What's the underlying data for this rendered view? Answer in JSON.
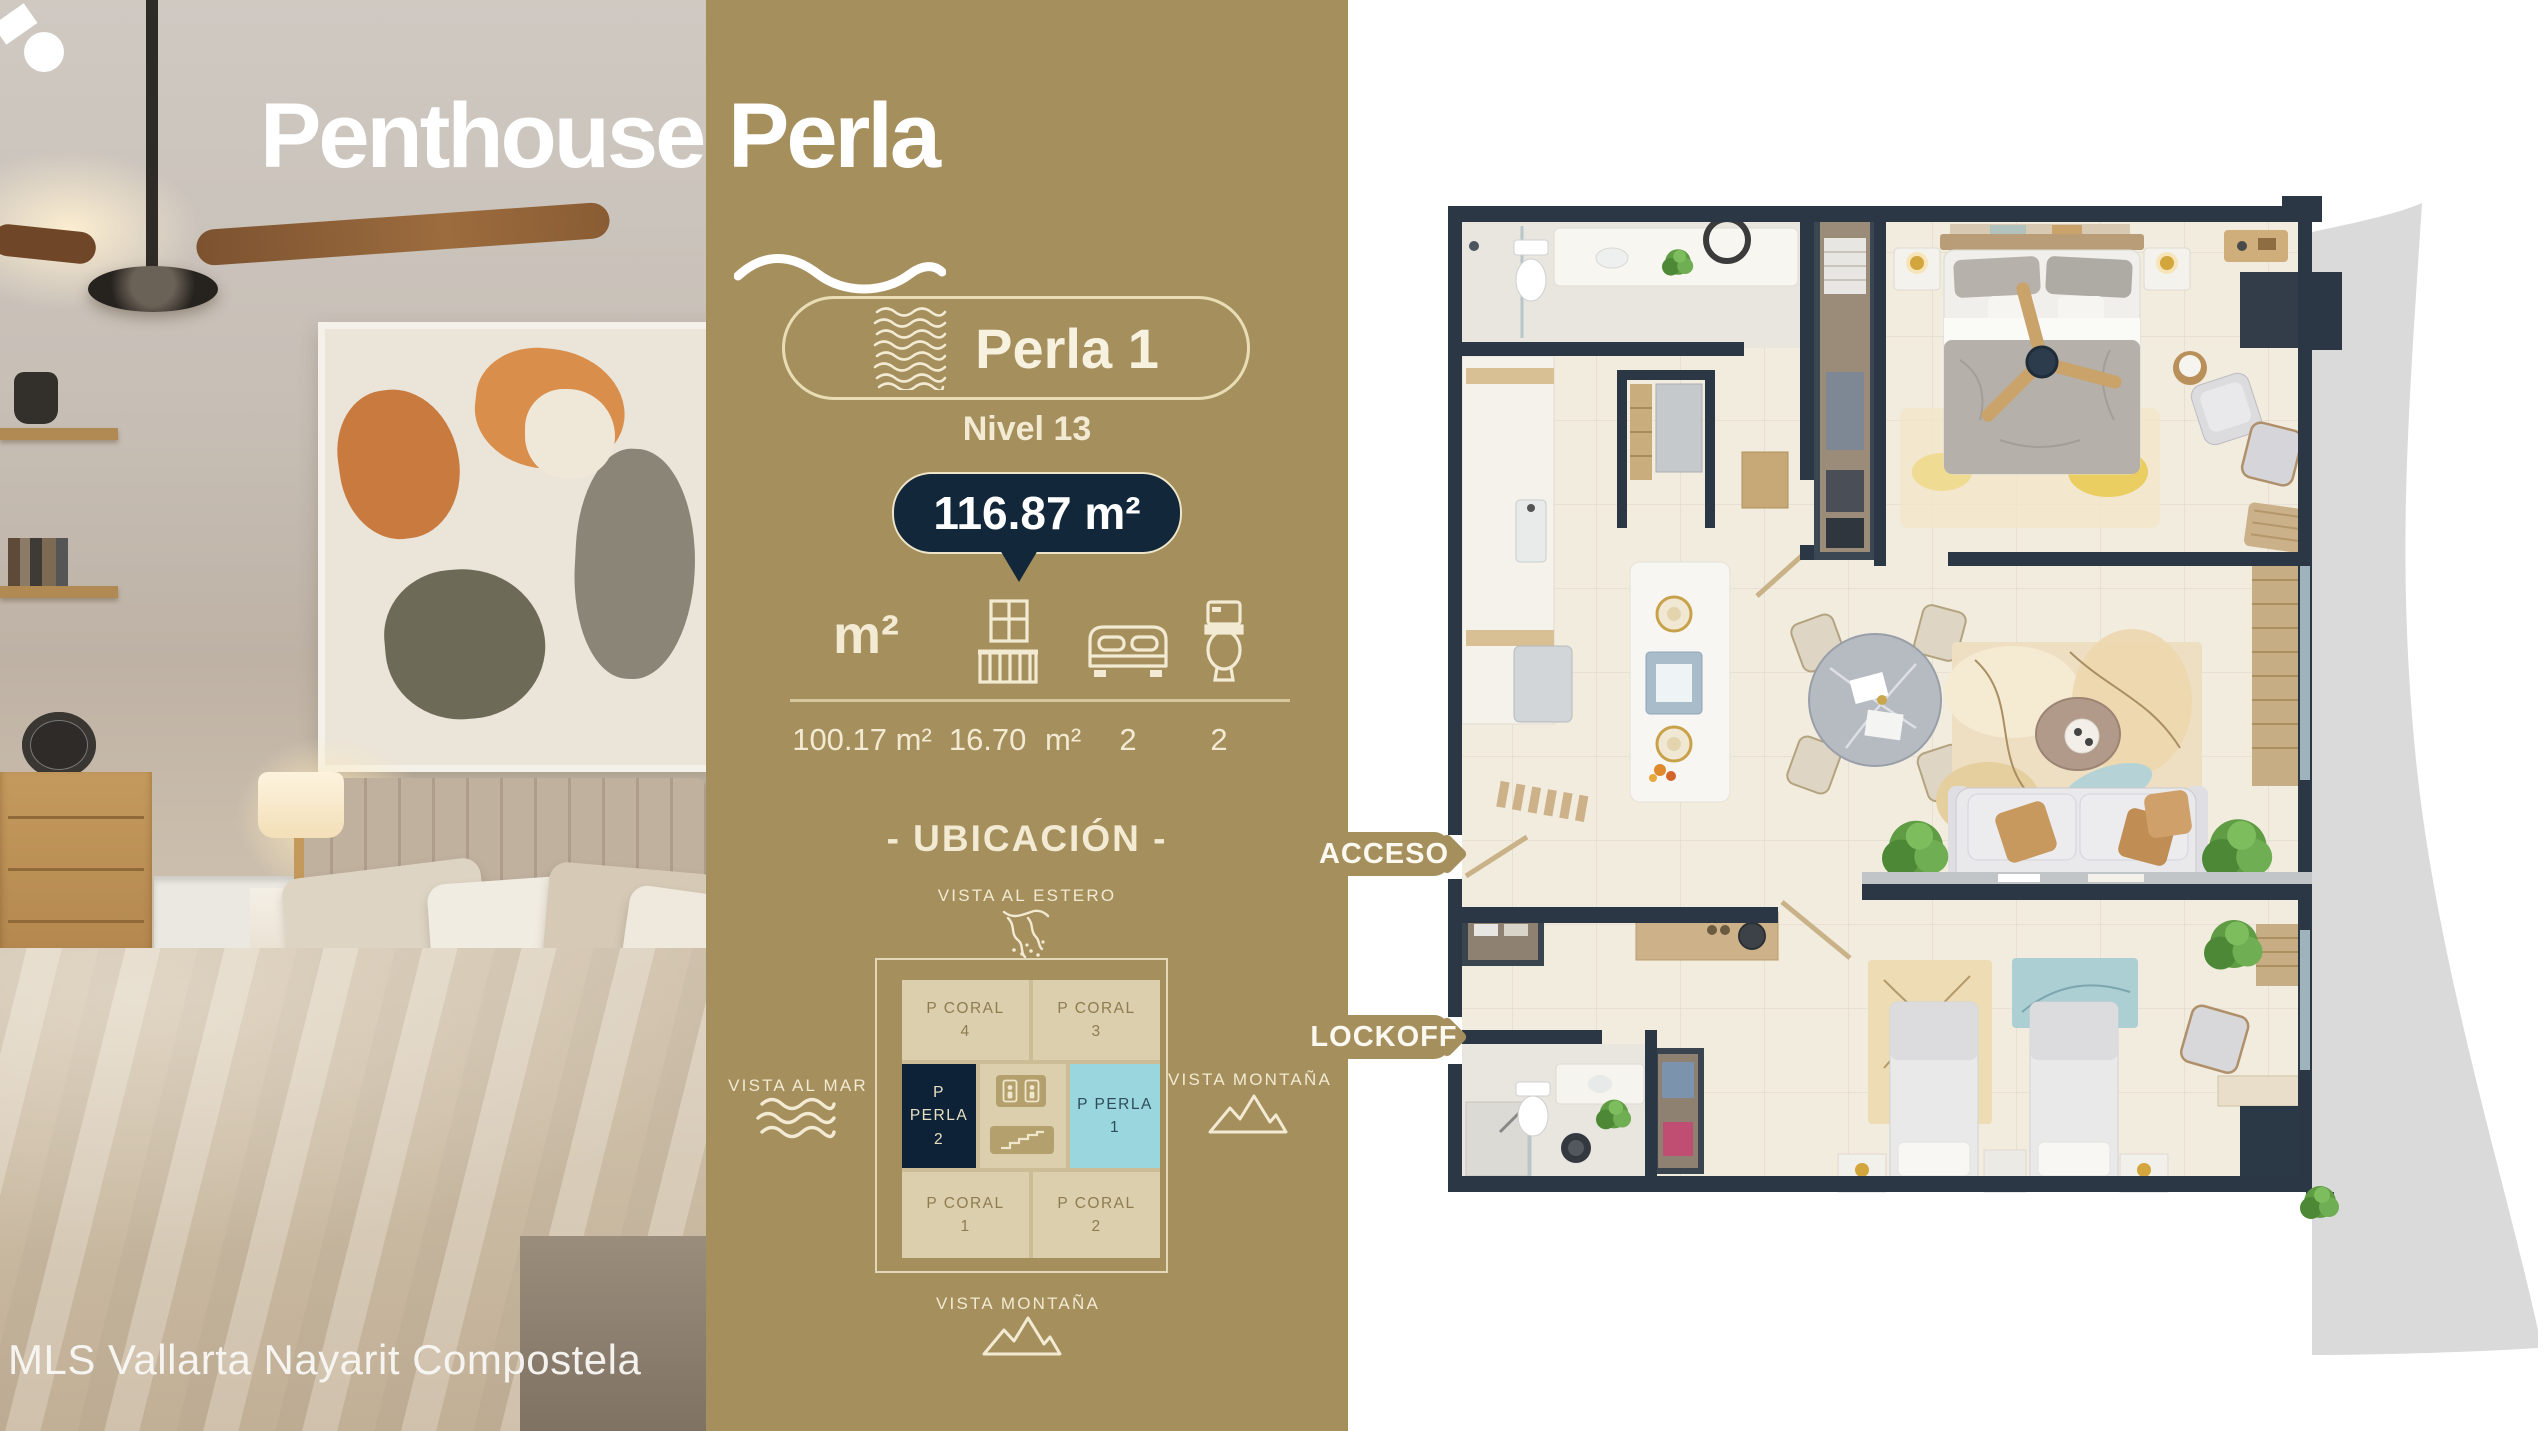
{
  "title": {
    "part1": "Penthouse",
    "part2": "Perla"
  },
  "watermark": "MLS Vallarta Nayarit Compostela",
  "unit": {
    "badge_label": "Perla 1",
    "level": "Nivel 13",
    "total_area": "116.87 m²"
  },
  "stats": {
    "area_icon_label": "m²",
    "values": [
      "100.17 m²",
      "16.70 m²",
      "2",
      "2"
    ]
  },
  "ubicacion": {
    "title": "- UBICACIÓN -",
    "vista_top": "VISTA AL ESTERO",
    "vista_left": "VISTA AL MAR",
    "vista_right": "VISTA MONTAÑA",
    "vista_bottom": "VISTA MONTAÑA",
    "grid": [
      {
        "name": "P CORAL",
        "num": "4"
      },
      {
        "name": "P CORAL",
        "num": "3"
      },
      {
        "name": "P PERLA",
        "num": "2"
      },
      {
        "name": "P PERLA",
        "num": "1"
      },
      {
        "name": "P CORAL",
        "num": "1"
      },
      {
        "name": "P CORAL",
        "num": "2"
      }
    ]
  },
  "callouts": {
    "acceso": "ACCESO",
    "lockoff": "LOCKOFF"
  },
  "lockoff_badge": {
    "line1": "LOCK",
    "line2": "OFF",
    "line3": "SYSTEM"
  },
  "colors": {
    "gold": "#a58f5d",
    "navy": "#12283a",
    "cyan": "#9ad6dd",
    "cell_beige": "#dbcfad",
    "wall_navy": "#2b3744",
    "hanger_teal": "#8cc3c6",
    "swoosh_gray": "#dadada",
    "cream": "#f2ead2"
  }
}
